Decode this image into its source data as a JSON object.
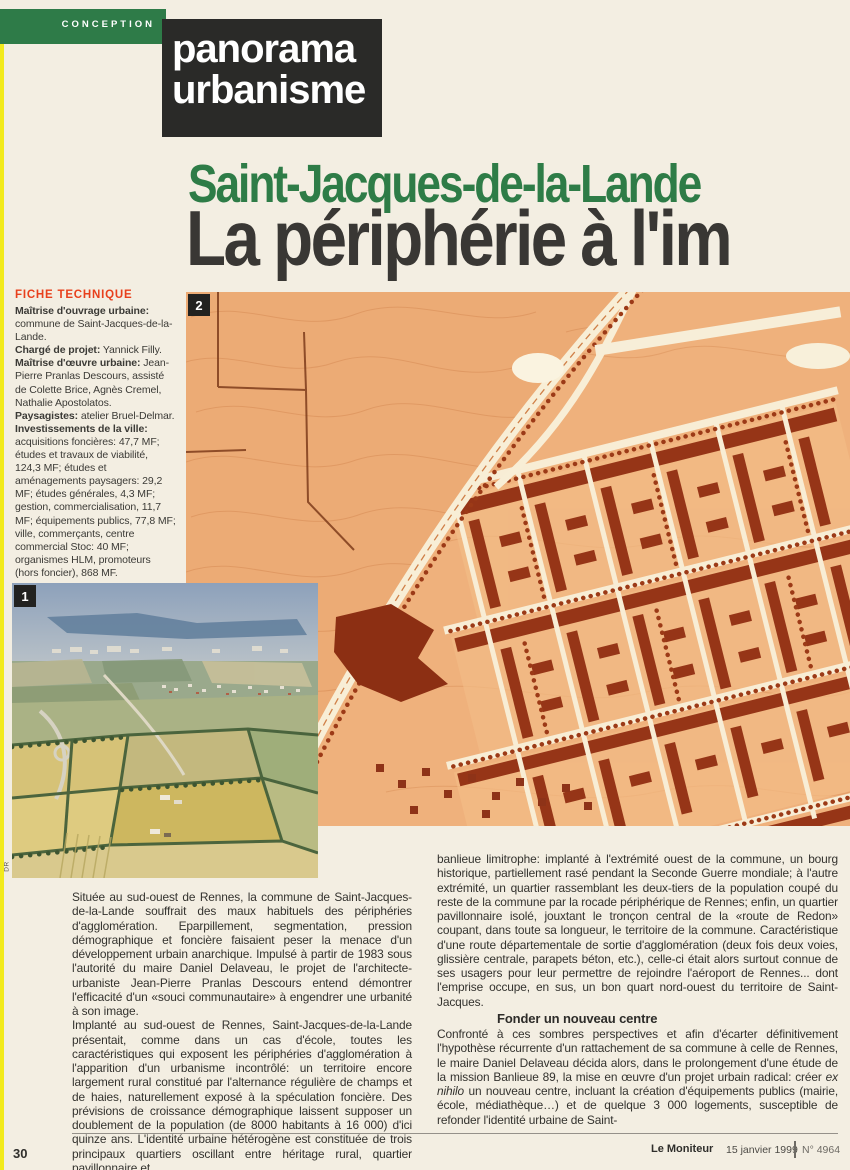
{
  "kicker": {
    "section": "CONCEPTION",
    "rubric_line1": "panorama",
    "rubric_line2": "urbanisme"
  },
  "headline": {
    "overline": "Saint-Jacques-de-la-Lande",
    "title": "La périphérie à l'im"
  },
  "fiche": {
    "heading": "FICHE TECHNIQUE",
    "entries": [
      {
        "label": "Maîtrise d'ouvrage urbaine:",
        "text": " commune de Saint-Jacques-de-la-Lande."
      },
      {
        "label": "Chargé de projet:",
        "text": " Yannick Filly."
      },
      {
        "label": "Maîtrise d'œuvre urbaine:",
        "text": " Jean-Pierre Pranlas Descours, assisté de Colette Brice, Agnès Cremel, Nathalie Apostolatos."
      },
      {
        "label": "Paysagistes:",
        "text": " atelier Bruel-Delmar."
      },
      {
        "label": "Investissements de la ville:",
        "text": " acquisitions foncières: 47,7 MF; études et travaux de viabilité, 124,3 MF; études et aménagements paysagers: 29,2 MF; études générales, 4,3 MF; gestion, commercialisation, 11,7 MF; équipements publics, 77,8 MF; ville, commerçants, centre commercial Stoc: 40 MF; organismes HLM, promoteurs (hors foncier), 868 MF."
      }
    ]
  },
  "figures": [
    {
      "label": "2"
    },
    {
      "label": "1",
      "credit": "DR"
    }
  ],
  "body": {
    "col1_p1": "Située au sud-ouest de Rennes, la commune de Saint-Jacques-de-la-Lande souffrait des maux habituels des périphéries d'agglomération. Eparpillement, segmentation, pression démographique et foncière faisaient peser la menace d'un développement urbain anarchique. Impulsé à partir de 1983 sous l'autorité du maire Daniel Delaveau, le projet de l'architecte-urbaniste Jean-Pierre Pranlas Descours entend démontrer l'efficacité d'un «souci communautaire» à engendrer une urbanité à son image.",
    "col1_p2": "Implanté au sud-ouest de Rennes, Saint-Jacques-de-la-Lande présentait, comme dans un cas d'école, toutes les caractéristiques qui exposent les périphéries d'agglomération à l'apparition d'un urbanisme incontrôlé: un territoire encore largement rural constitué par l'alternance régulière de champs et de haies, naturellement exposé à la spéculation foncière. Des prévisions de croissance démographique laissent supposer un doublement de la population (de 8000 habitants à 16 000) d'ici quinze ans. L'identité urbaine hétérogène est constituée de trois principaux quartiers oscillant entre héritage rural, quartier pavillonnaire et",
    "col2_p1": "banlieue limitrophe: implanté à l'extrémité ouest de la commune, un bourg historique, partiellement rasé pendant la Seconde Guerre mondiale; à l'autre extrémité, un quartier rassemblant les deux-tiers de la population coupé du reste de la commune par la rocade périphérique de Rennes; enfin, un quartier pavillonnaire isolé, jouxtant le tronçon central de la «route de Redon» coupant, dans toute sa longueur, le territoire de la commune. Caractéristique d'une route départementale de sortie d'agglomération (deux fois deux voies, glissière centrale, parapets béton, etc.), celle-ci était alors surtout connue de ses usagers pour leur permettre de rejoindre l'aéroport de Rennes... dont l'emprise occupe, en sus, un bon quart nord-ouest du territoire de Saint-Jacques.",
    "subhead": "Fonder un nouveau centre",
    "col2_p2a": "Confronté à ces sombres perspectives et afin d'écarter définitivement l'hypothèse récurrente d'un rattachement de sa commune à celle de Rennes, le maire Daniel Delaveau décida alors, dans le prolongement d'une étude de la mission Banlieue 89, la mise en œuvre d'un projet urbain radical: créer ",
    "col2_p2_italic": "ex nihilo",
    "col2_p2b": " un nouveau centre, incluant la création d'équipements publics (mairie, école, médiathèque…) et de quelque 3 000 logements, susceptible de refonder l'identité urbaine de Saint-"
  },
  "footer": {
    "page_number": "30",
    "publication": "Le Moniteur",
    "date": "15 janvier 1999",
    "issue": "N° 4964"
  },
  "colors": {
    "accent_green": "#2E7B48",
    "rubric_black": "#2A2A28",
    "fiche_red": "#E8401C",
    "map_sepia": "#ECAA74",
    "map_building": "#96351A",
    "edge_yellow": "#F2EA1C"
  }
}
